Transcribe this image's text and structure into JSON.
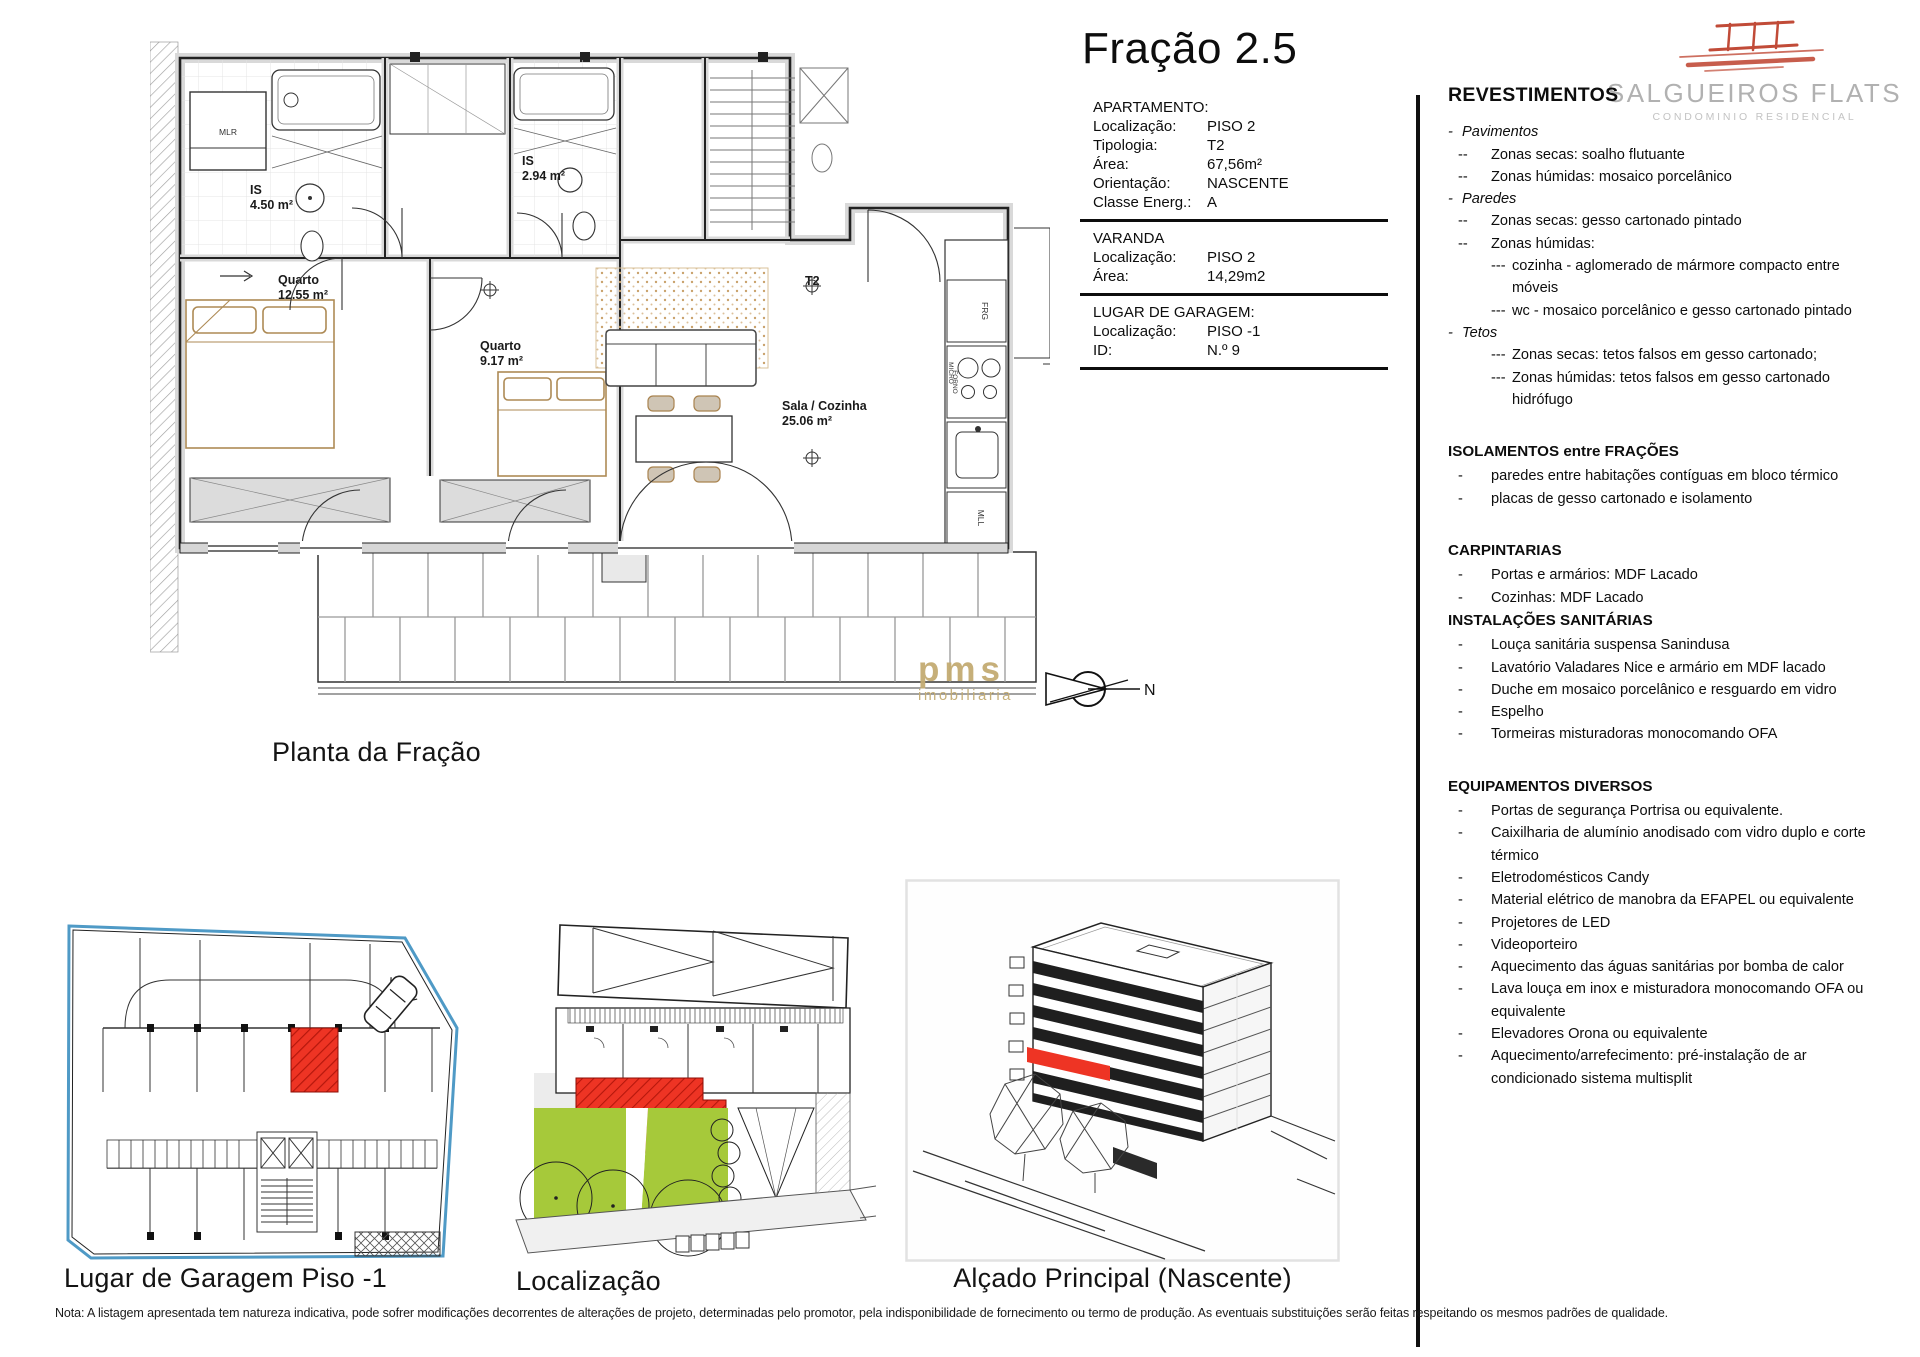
{
  "title": "Fração 2.5",
  "info": {
    "sections": [
      {
        "heading": "APARTAMENTO:",
        "rows": [
          {
            "label": "Localização:",
            "value": "PISO 2"
          },
          {
            "label": "Tipologia:",
            "value": "T2"
          },
          {
            "label": "Área:",
            "value": "67,56m²"
          },
          {
            "label": "Orientação:",
            "value": "NASCENTE"
          },
          {
            "label": "Classe Energ.:",
            "value": "A"
          }
        ]
      },
      {
        "heading": "VARANDA",
        "rows": [
          {
            "label": "Localização:",
            "value": "PISO 2"
          },
          {
            "label": "Área:",
            "value": "14,29m2"
          }
        ]
      },
      {
        "heading": "LUGAR DE GARAGEM:",
        "rows": [
          {
            "label": "Localização:",
            "value": "PISO -1"
          },
          {
            "label": "ID:",
            "value": "N.º 9"
          }
        ]
      }
    ]
  },
  "logo": {
    "name": "SALGUEIROS FLATS",
    "subtitle": "CONDOMINIO RESIDENCIAL"
  },
  "specs": {
    "title": "REVESTIMENTOS",
    "sections": [
      {
        "heading": "",
        "cls": "first",
        "lines": [
          {
            "b": "-",
            "t": "Pavimentos",
            "cls": "lvl0"
          },
          {
            "b": "--",
            "t": "Zonas secas: soalho flutuante",
            "cls": "lvl1"
          },
          {
            "b": "--",
            "t": "Zonas húmidas: mosaico porcelânico",
            "cls": "lvl1"
          },
          {
            "b": "-",
            "t": "Paredes",
            "cls": "lvl0"
          },
          {
            "b": "--",
            "t": "Zonas secas: gesso cartonado pintado",
            "cls": "lvl1"
          },
          {
            "b": "--",
            "t": "Zonas húmidas:",
            "cls": "lvl1"
          },
          {
            "b": "---",
            "t": "cozinha - aglomerado de mármore compacto entre móveis",
            "cls": "lvl2"
          },
          {
            "b": "---",
            "t": "wc - mosaico porcelânico e gesso cartonado pintado",
            "cls": "lvl2"
          },
          {
            "b": "-",
            "t": "Tetos",
            "cls": "lvl0"
          },
          {
            "b": "---",
            "t": "Zonas secas: tetos falsos em gesso cartonado;",
            "cls": "lvl2"
          },
          {
            "b": "---",
            "t": "Zonas húmidas: tetos falsos em gesso cartonado hidrófugo",
            "cls": "lvl2"
          }
        ]
      },
      {
        "heading": "ISOLAMENTOS entre FRAÇÕES",
        "cls": "",
        "lines": [
          {
            "b": "-",
            "t": "paredes entre habitações contíguas em bloco térmico",
            "cls": "lvl1"
          },
          {
            "b": "-",
            "t": "placas de gesso cartonado e isolamento",
            "cls": "lvl1"
          }
        ]
      },
      {
        "heading": "CARPINTARIAS",
        "cls": "",
        "lines": [
          {
            "b": "-",
            "t": "Portas e armários: MDF Lacado",
            "cls": "lvl1"
          },
          {
            "b": "-",
            "t": "Cozinhas: MDF Lacado",
            "cls": "lvl1"
          }
        ]
      },
      {
        "heading": "INSTALAÇÕES SANITÁRIAS",
        "cls": "tight",
        "lines": [
          {
            "b": "-",
            "t": "Louça sanitária suspensa Sanindusa",
            "cls": "lvl1"
          },
          {
            "b": "-",
            "t": "Lavatório Valadares Nice e armário em MDF lacado",
            "cls": "lvl1"
          },
          {
            "b": "-",
            "t": "Duche em mosaico porcelânico e resguardo em vidro",
            "cls": "lvl1"
          },
          {
            "b": "-",
            "t": "Espelho",
            "cls": "lvl1"
          },
          {
            "b": "-",
            "t": "Tormeiras misturadoras monocomando OFA",
            "cls": "lvl1"
          }
        ]
      },
      {
        "heading": "EQUIPAMENTOS DIVERSOS",
        "cls": "",
        "lines": [
          {
            "b": "-",
            "t": "Portas de segurança Portrisa ou equivalente.",
            "cls": "lvl1"
          },
          {
            "b": "-",
            "t": "Caixilharia de alumínio anodisado com vidro duplo e corte térmico",
            "cls": "lvl1"
          },
          {
            "b": "-",
            "t": "Eletrodomésticos Candy",
            "cls": "lvl1"
          },
          {
            "b": "-",
            "t": "Material elétrico de manobra da EFAPEL ou equivalente",
            "cls": "lvl1"
          },
          {
            "b": "-",
            "t": "Projetores de LED",
            "cls": "lvl1"
          },
          {
            "b": "-",
            "t": "Videoporteiro",
            "cls": "lvl1"
          },
          {
            "b": "-",
            "t": "Aquecimento das águas sanitárias por bomba de calor",
            "cls": "lvl1"
          },
          {
            "b": "-",
            "t": "Lava louça em inox e misturadora monocomando OFA ou equivalente",
            "cls": "lvl1"
          },
          {
            "b": "-",
            "t": "Elevadores Orona ou equivalente",
            "cls": "lvl1"
          },
          {
            "b": "-",
            "t": "Aquecimento/arrefecimento: pré-instalação de ar condicionado sistema multisplit",
            "cls": "lvl1"
          }
        ]
      }
    ]
  },
  "plan": {
    "caption": "Planta da Fração",
    "rooms": {
      "is1": "IS",
      "is1_area": "4.50 m²",
      "quarto1": "Quarto",
      "quarto1_area": "12.55 m²",
      "is2": "IS",
      "is2_area": "2.94 m²",
      "quarto2": "Quarto",
      "quarto2_area": "9.17 m²",
      "sala": "Sala / Cozinha",
      "sala_area": "25.06 m²",
      "entry": "T2",
      "mlr": "MLR",
      "frg": "FRG",
      "micro": "MICRO",
      "forno": "FORNO",
      "mll": "MLL"
    }
  },
  "garage": {
    "caption": "Lugar de Garagem Piso -1"
  },
  "location": {
    "caption": "Localização"
  },
  "elevation": {
    "caption": "Alçado Principal (Nascente)"
  },
  "compass": {
    "label": "N"
  },
  "watermark": {
    "line1": "pms",
    "line2": "imobiliaria"
  },
  "note": "Nota: A listagem apresentada tem natureza indicativa, pode sofrer modificações decorrentes de alterações de projeto, determinadas pelo promotor, pela indisponibilidade de fornecimento ou termo de produção. As eventuais substituições serão feitas respeitando os mesmos padrões de qualidade.",
  "colors": {
    "red": "#ee3424",
    "green": "#a6c93a",
    "blue": "#4f9ac6",
    "gold": "#c3ab72",
    "tan": "#ad8a55"
  }
}
